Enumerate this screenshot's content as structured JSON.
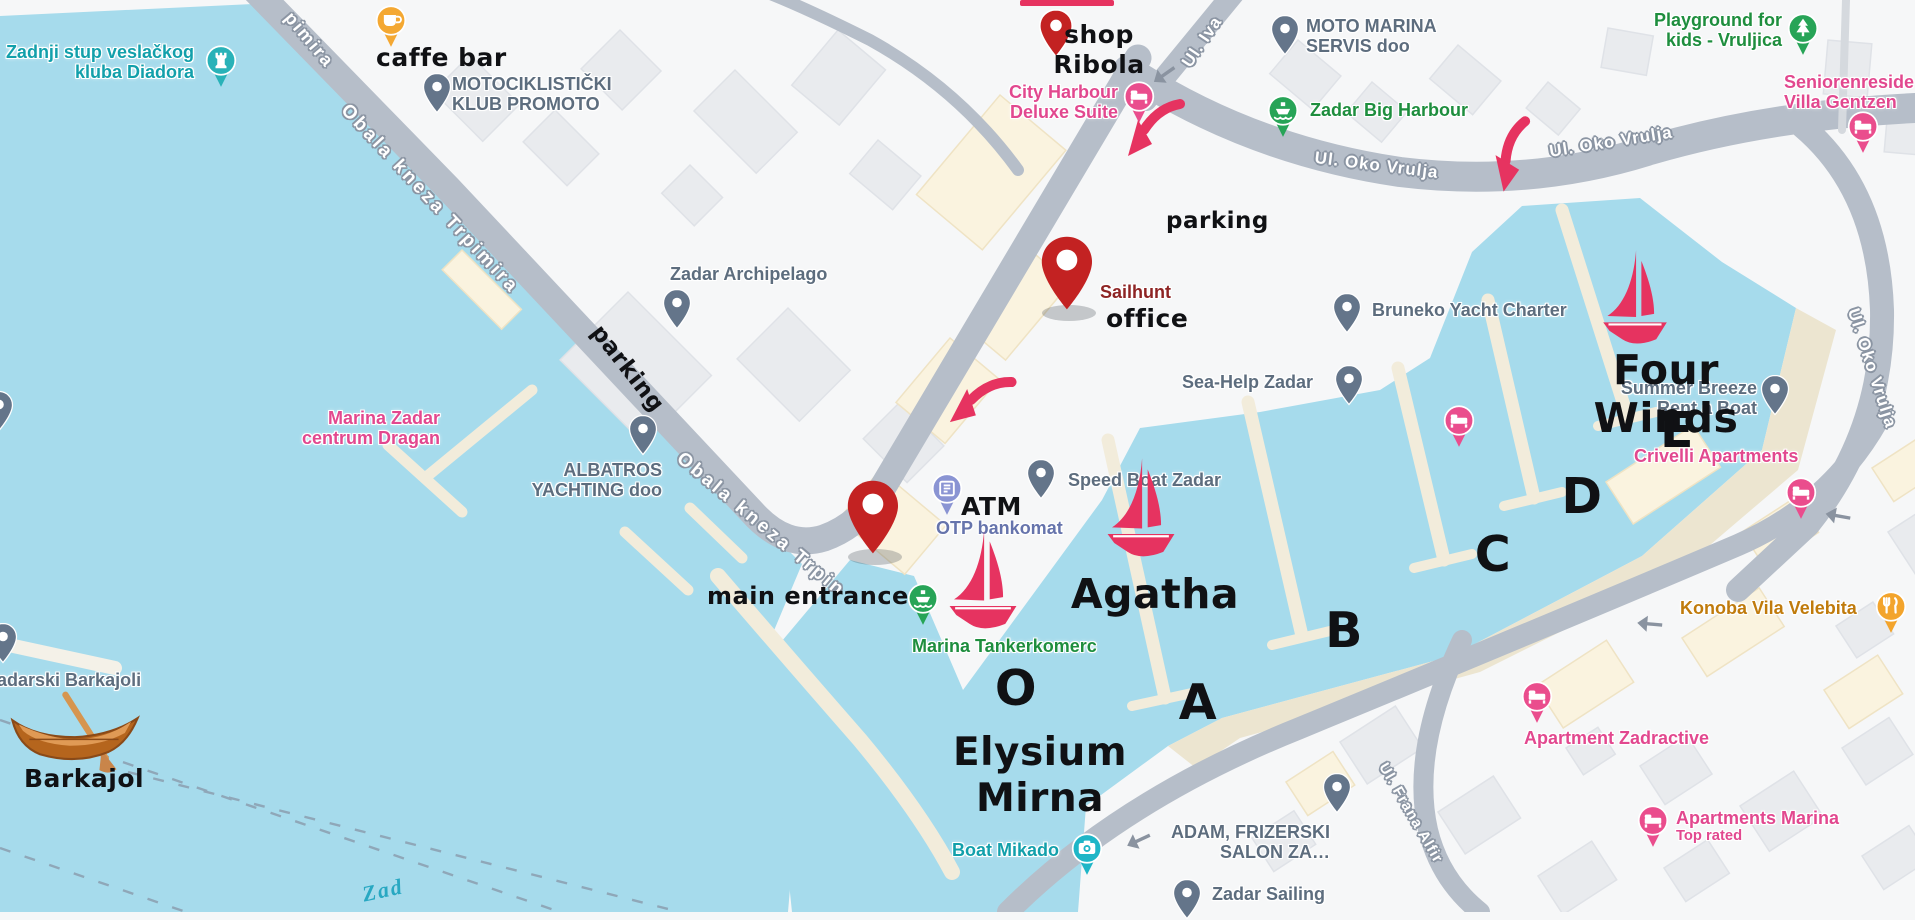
{
  "map": {
    "colors": {
      "water": "#a6dbec",
      "land": "#f6f7f8",
      "road": "#b6bec9",
      "pier": "#f2ecdb",
      "shore": "#ece5d0",
      "building_gray": "#e9ebee",
      "building_cream": "#faf3df",
      "poi_gray": "#5d6d7e",
      "poi_green": "#1e8e3e",
      "poi_pink": "#e2488f",
      "poi_teal": "#12a0ab",
      "poi_indigo": "#6674ac",
      "poi_amber": "#c07b0c",
      "annotation_black": "#101114",
      "annotation_red_pin": "#c32222",
      "sailhunt_maroon": "#8e2424",
      "crimson": "#e63360"
    },
    "streets": [
      {
        "name": "street-obala-kneza-trpimira-partial",
        "t": "pimira",
        "x": 296,
        "y": 8,
        "r": 50,
        "s": 18,
        "ls": 2
      },
      {
        "name": "street-obala-kneza-trpimira",
        "t": "Obala kneza Trpimira",
        "x": 352,
        "y": 100,
        "r": 47,
        "s": 19,
        "ls": 3
      },
      {
        "name": "street-obala-kneza-trpimira-2",
        "t": "Obala kneza Trpin",
        "x": 686,
        "y": 448,
        "r": 40,
        "s": 19,
        "ls": 3
      },
      {
        "name": "street-ul-iva",
        "t": "Ul. Iva",
        "x": 1178,
        "y": 60,
        "r": -56,
        "s": 17,
        "ls": 1
      },
      {
        "name": "street-ul-oko-vrulja-1",
        "t": "Ul. Oko Vrulja",
        "x": 1316,
        "y": 148,
        "r": 7,
        "s": 17,
        "ls": 1
      },
      {
        "name": "street-ul-oko-vrulja-2",
        "t": "Ul. Oko Vrulja",
        "x": 1548,
        "y": 142,
        "r": -9,
        "s": 17,
        "ls": 1
      },
      {
        "name": "street-ul-oko-vrulja-3",
        "t": "Ul. Oko Vrulja",
        "x": 1862,
        "y": 306,
        "r": 72,
        "s": 17,
        "ls": 1
      },
      {
        "name": "street-ul-frana-alfirevica",
        "t": "Ul. Frana Alfir",
        "x": 1390,
        "y": 760,
        "r": 60,
        "s": 15,
        "ls": 1
      }
    ],
    "water_labels": [
      {
        "name": "water-label-zadar-channel",
        "t": "Zad",
        "x": 360,
        "y": 882,
        "r": -12,
        "s": 22
      }
    ],
    "annotations": [
      {
        "name": "annotation-caffe-bar",
        "text": "caffe bar",
        "x": 376,
        "y": 43,
        "s": 25
      },
      {
        "name": "annotation-shop-ribola",
        "text": "shop\nRibola",
        "x": 1099,
        "y": 20,
        "s": 25,
        "cx": true
      },
      {
        "name": "annotation-parking-west",
        "text": "parking",
        "x": 606,
        "y": 320,
        "s": 23,
        "r": 52
      },
      {
        "name": "annotation-parking-east",
        "text": "parking",
        "x": 1166,
        "y": 208,
        "s": 23
      },
      {
        "name": "annotation-office",
        "text": "office",
        "x": 1106,
        "y": 304,
        "s": 25
      },
      {
        "name": "annotation-main-entrance",
        "text": "main entrance",
        "x": 707,
        "y": 582,
        "s": 24
      },
      {
        "name": "annotation-atm",
        "text": "ATM",
        "x": 961,
        "y": 492,
        "s": 25
      },
      {
        "name": "annotation-barkajol",
        "text": "Barkajol",
        "x": 24,
        "y": 764,
        "s": 25
      },
      {
        "name": "annotation-boat-agatha",
        "text": "Agatha",
        "x": 1155,
        "y": 570,
        "s": 41,
        "cx": true
      },
      {
        "name": "annotation-boat-four-winds",
        "text": "Four Winds",
        "x": 1666,
        "y": 346,
        "s": 41,
        "cx": true
      },
      {
        "name": "annotation-boat-elysium-mirna",
        "text": "Elysium\nMirna",
        "x": 1040,
        "y": 730,
        "s": 39,
        "cx": true
      },
      {
        "name": "annotation-pier-o",
        "text": "O",
        "x": 1016,
        "y": 660,
        "s": 49,
        "cx": true
      },
      {
        "name": "annotation-pier-a",
        "text": "A",
        "x": 1198,
        "y": 674,
        "s": 49,
        "cx": true
      },
      {
        "name": "annotation-pier-b",
        "text": "B",
        "x": 1344,
        "y": 602,
        "s": 49,
        "cx": true
      },
      {
        "name": "annotation-pier-c",
        "text": "C",
        "x": 1493,
        "y": 526,
        "s": 49,
        "cx": true
      },
      {
        "name": "annotation-pier-d",
        "text": "D",
        "x": 1582,
        "y": 468,
        "s": 49,
        "cx": true
      },
      {
        "name": "annotation-pier-e",
        "text": "E",
        "x": 1677,
        "y": 402,
        "s": 49,
        "cx": true
      }
    ],
    "pois": [
      {
        "name": "poi-zadnji-stup-diadora",
        "label": {
          "lines": [
            "Zadnji stup veslačkog",
            "kluba Diadora"
          ],
          "x": 194,
          "y": 42,
          "color": "#12a0ab",
          "align": "right"
        },
        "marker": {
          "type": "badge",
          "color": "#29b2b8",
          "icon": "rook",
          "x": 204,
          "y": 44
        }
      },
      {
        "name": "poi-motociklisticki-klub-promoto",
        "label": {
          "lines": [
            "MOTOCIKLISTIČKI",
            "KLUB PROMOTO"
          ],
          "x": 452,
          "y": 74,
          "color": "#5d6d7e"
        },
        "marker": {
          "type": "pin",
          "color": "#64758a",
          "x": 422,
          "y": 72
        }
      },
      {
        "name": "poi-city-harbour-deluxe-suite",
        "label": {
          "lines": [
            "City Harbour",
            "Deluxe Suite"
          ],
          "x": 1118,
          "y": 82,
          "color": "#e2488f",
          "align": "right"
        },
        "marker": {
          "type": "badge",
          "color": "#ea4d8d",
          "icon": "bed",
          "x": 1122,
          "y": 80
        }
      },
      {
        "name": "poi-moto-marina-servis",
        "label": {
          "lines": [
            "MOTO MARINA",
            "SERVIS doo"
          ],
          "x": 1306,
          "y": 16,
          "color": "#5d6d7e"
        },
        "marker": {
          "type": "pin",
          "color": "#64758a",
          "x": 1270,
          "y": 14
        }
      },
      {
        "name": "poi-zadar-big-harbour",
        "label": {
          "lines": [
            "Zadar Big Harbour"
          ],
          "x": 1310,
          "y": 100,
          "color": "#1e8e3e"
        },
        "marker": {
          "type": "badge",
          "color": "#27a457",
          "icon": "ship",
          "x": 1266,
          "y": 94
        }
      },
      {
        "name": "poi-playground-vruljica",
        "label": {
          "lines": [
            "Playground for",
            "kids - Vruljica"
          ],
          "x": 1782,
          "y": 10,
          "color": "#1e8e3e",
          "align": "right"
        },
        "marker": {
          "type": "badge",
          "color": "#27a457",
          "icon": "tree",
          "x": 1786,
          "y": 12
        }
      },
      {
        "name": "poi-seniorenresidenz-villa-gentzen",
        "label": {
          "lines": [
            "Seniorenreside",
            "Villa Gentzen"
          ],
          "x": 1784,
          "y": 72,
          "color": "#e2488f"
        },
        "marker": {
          "type": "badge",
          "color": "#ea4d8d",
          "icon": "bed",
          "x": 1846,
          "y": 110
        }
      },
      {
        "name": "poi-zadar-archipelago",
        "label": {
          "lines": [
            "Zadar Archipelago"
          ],
          "x": 670,
          "y": 264,
          "color": "#5d6d7e"
        },
        "marker": {
          "type": "pin",
          "color": "#64758a",
          "x": 662,
          "y": 288
        }
      },
      {
        "name": "poi-sailhunt-office",
        "label": {
          "lines": [
            "Sailhunt"
          ],
          "x": 1100,
          "y": 282,
          "color": "#8e2424"
        },
        "marker": {
          "type": "bigpin",
          "color": "#c32222",
          "x": 1038,
          "y": 234
        }
      },
      {
        "name": "poi-bruneko-yacht-charter",
        "label": {
          "lines": [
            "Bruneko Yacht Charter"
          ],
          "x": 1372,
          "y": 300,
          "color": "#5d6d7e"
        },
        "marker": {
          "type": "pin",
          "color": "#64758a",
          "x": 1332,
          "y": 292
        }
      },
      {
        "name": "poi-sea-help-zadar",
        "label": {
          "lines": [
            "Sea-Help Zadar"
          ],
          "x": 1182,
          "y": 372,
          "color": "#5d6d7e"
        },
        "marker": {
          "type": "pin",
          "color": "#64758a",
          "x": 1334,
          "y": 364
        }
      },
      {
        "name": "poi-summer-breeze-rent-a-boat",
        "label": {
          "lines": [
            "Summer Breeze",
            "Rent a Boat"
          ],
          "x": 1757,
          "y": 378,
          "color": "#5d6d7e",
          "align": "right"
        },
        "marker": {
          "type": "pin",
          "color": "#64758a",
          "x": 1760,
          "y": 374
        }
      },
      {
        "name": "poi-crivelli-apartments",
        "label": {
          "lines": [
            "Crivelli Apartments"
          ],
          "x": 1634,
          "y": 446,
          "color": "#e2488f"
        },
        "marker": {
          "type": "badge",
          "color": "#ea4d8d",
          "icon": "bed",
          "x": 1784,
          "y": 476
        }
      },
      {
        "name": "poi-marina-zadar-centrum-dragan",
        "label": {
          "lines": [
            "Marina Zadar",
            "centrum Dragan"
          ],
          "x": 1440,
          "y": 0,
          "color": "#e2488f",
          "align": "right",
          "rx": 440,
          "ry": 408
        },
        "marker": {
          "type": "badge",
          "color": "#ea4d8d",
          "icon": "bed",
          "x": 1442,
          "y": 404
        }
      },
      {
        "name": "poi-albatros-yachting",
        "label": {
          "lines": [
            "ALBATROS",
            "YACHTING doo"
          ],
          "x": 662,
          "y": 460,
          "color": "#5d6d7e",
          "align": "right"
        },
        "marker": {
          "type": "pin",
          "color": "#64758a",
          "x": 628,
          "y": 414
        }
      },
      {
        "name": "poi-speed-boat-zadar",
        "label": {
          "lines": [
            "Speed Boat Zadar"
          ],
          "x": 1068,
          "y": 470,
          "color": "#5d6d7e"
        },
        "marker": {
          "type": "pin",
          "color": "#64758a",
          "x": 1026,
          "y": 458
        }
      },
      {
        "name": "poi-otp-bankomat",
        "label": {
          "lines": [
            "OTP bankomat"
          ],
          "x": 936,
          "y": 518,
          "color": "#6674ac"
        },
        "marker": {
          "type": "badge",
          "color": "#8a94d3",
          "icon": "atm",
          "x": 930,
          "y": 472
        }
      },
      {
        "name": "poi-marina-tankerkomerc",
        "label": {
          "lines": [
            "Marina Tankerkomerc"
          ],
          "x": 912,
          "y": 636,
          "color": "#1e8e3e"
        },
        "marker": {
          "type": "badge",
          "color": "#27a457",
          "icon": "ship",
          "x": 906,
          "y": 582
        }
      },
      {
        "name": "poi-boat-mikado",
        "label": {
          "lines": [
            "Boat Mikado"
          ],
          "x": 952,
          "y": 840,
          "color": "#12a0ab"
        },
        "marker": {
          "type": "badge",
          "color": "#1fb6c7",
          "icon": "camera",
          "x": 1070,
          "y": 832
        }
      },
      {
        "name": "poi-adam-frizerski-salon",
        "label": {
          "lines": [
            "ADAM, FRIZERSKI",
            "SALON ZA…"
          ],
          "x": 1330,
          "y": 822,
          "color": "#5d6d7e",
          "align": "right"
        },
        "marker": {
          "type": "pin",
          "color": "#64758a",
          "x": 1322,
          "y": 772
        }
      },
      {
        "name": "poi-zadar-sailing",
        "label": {
          "lines": [
            "Zadar Sailing"
          ],
          "x": 1212,
          "y": 884,
          "color": "#5d6d7e"
        },
        "marker": {
          "type": "pin",
          "color": "#64758a",
          "x": 1172,
          "y": 878
        }
      },
      {
        "name": "poi-konoba-vila-velebita",
        "label": {
          "lines": [
            "Konoba Vila Velebita"
          ],
          "x": 1680,
          "y": 598,
          "color": "#c07b0c"
        },
        "marker": {
          "type": "badge",
          "color": "#f3a42c",
          "icon": "food",
          "x": 1874,
          "y": 590
        }
      },
      {
        "name": "poi-apartment-zadractive",
        "label": {
          "lines": [
            "Apartment Zadractive"
          ],
          "x": 1524,
          "y": 728,
          "color": "#e2488f"
        },
        "marker": {
          "type": "badge",
          "color": "#ea4d8d",
          "icon": "bed",
          "x": 1520,
          "y": 680
        }
      },
      {
        "name": "poi-apartments-marina",
        "label": {
          "lines": [
            "Apartments Marina"
          ],
          "x": 1676,
          "y": 808,
          "color": "#e2488f",
          "sub": "Top rated"
        },
        "marker": {
          "type": "badge",
          "color": "#ea4d8d",
          "icon": "bed",
          "x": 1636,
          "y": 804
        }
      },
      {
        "name": "poi-zadarski-barkajoli",
        "label": {
          "lines": [
            "Zadarski Barkajoli"
          ],
          "x": -14,
          "y": 670,
          "color": "#5d6d7e"
        },
        "marker": {
          "type": "pin",
          "color": "#64758a",
          "x": -12,
          "y": 622
        }
      },
      {
        "name": "poi-edge-pin-west",
        "label": null,
        "marker": {
          "type": "pin",
          "color": "#64758a",
          "x": -16,
          "y": 390
        }
      },
      {
        "name": "poi-caffe-bar-marker",
        "label": null,
        "marker": {
          "type": "badge",
          "color": "#f4a832",
          "icon": "coffee",
          "x": 374,
          "y": 4
        }
      },
      {
        "name": "poi-shop-ribola-marker",
        "label": null,
        "marker": {
          "type": "pin",
          "color": "#c32222",
          "x": 1038,
          "y": 8,
          "w": 36
        }
      },
      {
        "name": "poi-main-entrance-marker",
        "label": null,
        "marker": {
          "type": "bigpin",
          "color": "#c32222",
          "x": 844,
          "y": 478
        }
      }
    ],
    "boats": {
      "sailboats": [
        {
          "name": "sailboat-agatha",
          "x": 1104,
          "y": 456,
          "w": 74
        },
        {
          "name": "sailboat-marina-o",
          "x": 946,
          "y": 528,
          "w": 74
        },
        {
          "name": "sailboat-four-winds",
          "x": 1600,
          "y": 248,
          "w": 70
        }
      ],
      "rowboat": {
        "name": "rowboat-barkajol",
        "x": 6,
        "y": 690,
        "w": 138,
        "h": 86
      }
    },
    "route_arrows": [
      {
        "name": "route-arrow-city-harbour",
        "x": 1122,
        "y": 96,
        "r": 0
      },
      {
        "name": "route-arrow-oko-vrulja",
        "x": 1484,
        "y": 122,
        "r": -28
      },
      {
        "name": "route-arrow-obala",
        "x": 948,
        "y": 368,
        "r": 12
      }
    ],
    "road_arrows": [
      {
        "name": "road-arrow-1",
        "x": 1152,
        "y": 64,
        "r": -35
      },
      {
        "name": "road-arrow-2",
        "x": 1824,
        "y": 506,
        "r": 10
      },
      {
        "name": "road-arrow-3",
        "x": 1636,
        "y": 614,
        "r": 5
      },
      {
        "name": "road-arrow-4",
        "x": 1126,
        "y": 830,
        "r": -25
      }
    ],
    "top_cut_arrow": {
      "name": "cut-arrow-top",
      "x": 1020,
      "y": 0,
      "w": 94,
      "h": 6
    }
  }
}
